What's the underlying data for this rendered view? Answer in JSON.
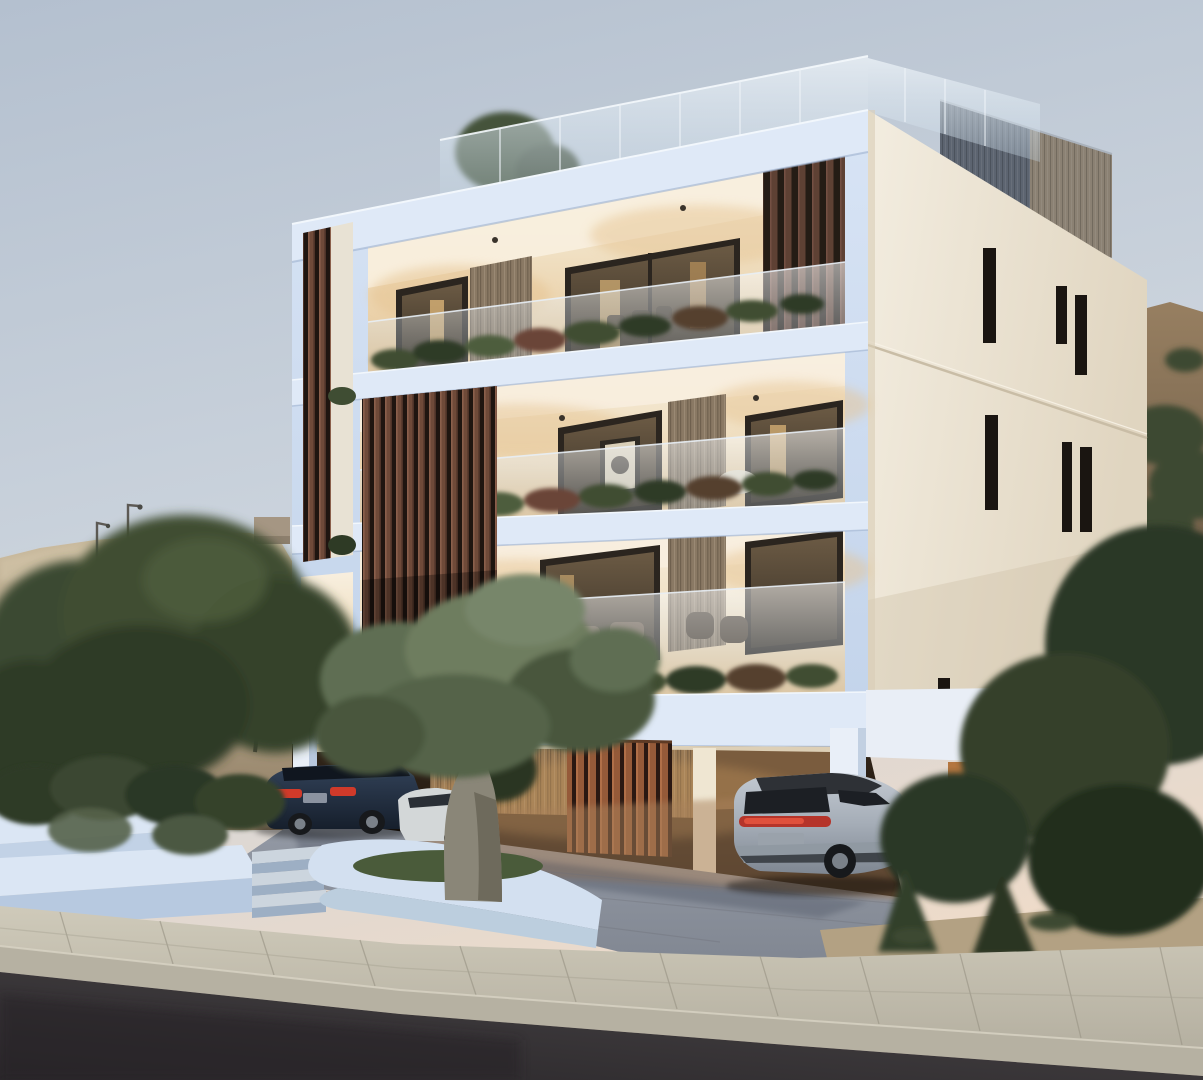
{
  "scene": {
    "type": "architectural-render",
    "time_of_day": "dusk",
    "subject": "modern three-storey apartment building with wooden louvers, lit balconies, rooftop glass balustrade, covered parking with three cars, olive tree, white planters, sidewalk and asphalt road",
    "objects": {
      "building": "white frame apartment block",
      "penthouse": "rooftop timber volume",
      "cars": [
        "dark blue sedan",
        "white sedan",
        "silver suv"
      ],
      "vegetation": [
        "olive tree",
        "garden shrubs",
        "background trees",
        "roof tree"
      ],
      "background": [
        "sandy hill with street lamps",
        "scrub hill"
      ],
      "foreground": [
        "white planter walls",
        "garden steps",
        "sidewalk",
        "road"
      ]
    }
  },
  "colors": {
    "sky_top": "#b4c0cf",
    "sky_mid": "#ccd4dd",
    "sky_horizon": "#eedbc9",
    "hill_sand_light": "#cabb9f",
    "hill_sand": "#b2a286",
    "hill_sand_shadow": "#8f7d64",
    "wall_block": "#a59683",
    "lamp_pole": "#5d5a55",
    "hill_right_top": "#977f61",
    "hill_right_base": "#6d5c47",
    "shrub_dark": "#3c4831",
    "tree_green": "#3f4d33",
    "tree_green_dark": "#2e3a25",
    "tree_green_light": "#4e5d3c",
    "facade_white_light": "#d8e4f5",
    "facade_white": "#c2d3ea",
    "facade_slab": "#dfe9f7",
    "facade_shadow": "#9db1cf",
    "facade_cream_light": "#f3ede0",
    "facade_cream_dark": "#e0d5c0",
    "slit_window": "#1a1511",
    "interior_ceiling": "#f8efdf",
    "interior_wall": "#f0e0c3",
    "interior_glow": "#e6c493",
    "window_frame": "#2b251f",
    "window_glass_top": "#6b5a44",
    "window_glass_bottom": "#362e24",
    "window_lit": "#d9b377",
    "wood_light": "#8a7964",
    "louver_slat": "#6f4a39",
    "louver_gap": "#1f1510",
    "louver_warm_slat": "#955a39",
    "louver_warm_gap": "#2a1812",
    "fin_slat": "#5e4134",
    "glass_top": "#ffffff",
    "glass_bottom": "#b9cbd9",
    "roof_glass_top": "#eef4f9",
    "roof_glass_bottom": "#c3d4e2",
    "penthouse_blue": "#5c6470",
    "penthouse_tan": "#8b8173",
    "parking_top": "#33261a",
    "parking_bottom": "#0f0b08",
    "parking_wood": "#9a7a55",
    "soffit": "#f0e2c8",
    "wall_orange": "#b4763f",
    "floor_warm": "#a8805a",
    "column_white": "#e9eff8",
    "sedan_top": "#33435a",
    "sedan_bottom": "#161f2c",
    "taillight": "#d03a2a",
    "car_white": "#d3d7d8",
    "suv_top": "#c3cad2",
    "suv_mid": "#a5adb7",
    "suv_bottom": "#7e8691",
    "suv_roof": "#2e3136",
    "suv_glass": "#1c1f24",
    "wheel": "#17191c",
    "rim": "#7a8189",
    "planter_top": "#dbe6f4",
    "planter_face": "#c2d2e6",
    "planter_shadow": "#9fb3d0",
    "step_tread": "#ccd5de",
    "step_riser": "#9dafc4",
    "grass": "#4a5b3a",
    "drive_top": "#949aa5",
    "drive_bottom": "#7f8590",
    "shadow_blue": "#3b4252",
    "sidewalk_top": "#cfcaba",
    "sidewalk_bottom": "#b5b0a1",
    "sidewalk_joint": "#9a9586",
    "curb_face": "#b6b1a2",
    "road_dark": "#2a272a",
    "road_light": "#4a4648",
    "sand": "#b3a183",
    "olive_light": "#6e7d5f",
    "olive_mid": "#5f6e52",
    "olive_dark": "#49573d",
    "olive_trunk": "#8a8678",
    "olive_trunk_dark": "#6e6a5c",
    "chair_white": "#e9e2d2",
    "wicker": "#473a2c"
  }
}
